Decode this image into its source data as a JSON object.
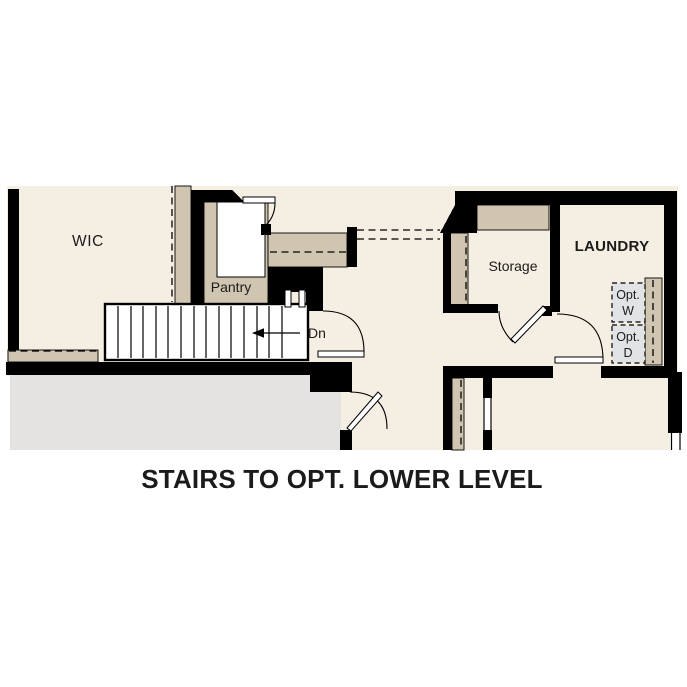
{
  "plan": {
    "rooms": {
      "wic": "WIC",
      "pantry": "Pantry",
      "storage": "Storage",
      "laundry": "LAUNDRY"
    },
    "stairs": {
      "direction_label": "Dn"
    },
    "optional_washer": {
      "line1": "Opt.",
      "line2": "W"
    },
    "optional_dryer": {
      "line1": "Opt.",
      "line2": "D"
    }
  },
  "caption": "STAIRS TO OPT. LOWER LEVEL",
  "colors": {
    "floor": "#f5eee2",
    "wall_fill": "#d0c5b1",
    "wall_line": "#000000",
    "garage_floor": "#e4e3e1",
    "optional_fixture": "#e2e3e5",
    "door_white": "#ffffff",
    "text_color": "#1b1b1b"
  }
}
